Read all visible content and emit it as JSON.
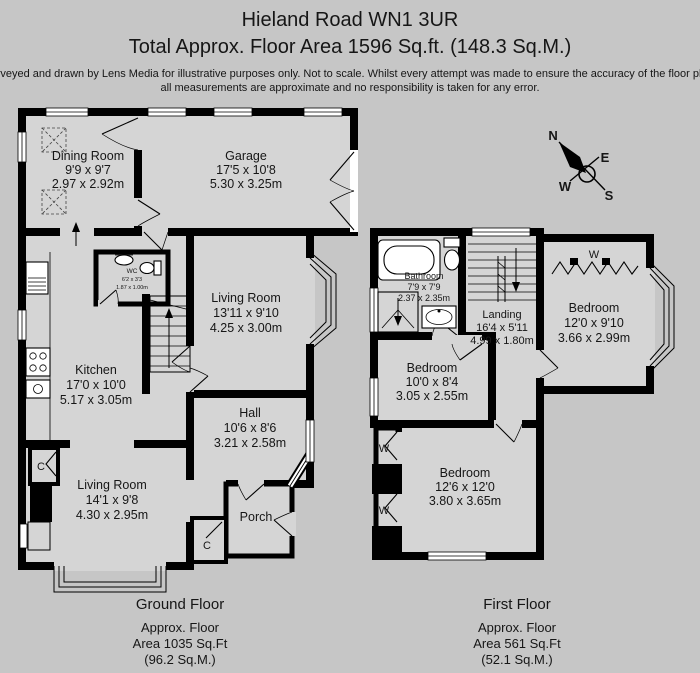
{
  "header": {
    "title": "Hieland Road WN1 3UR",
    "subtitle": "Total Approx. Floor Area 1596 Sq.ft. (148.3 Sq.M.)",
    "disclaimer1": "Surveyed and drawn by Lens Media for illustrative purposes only. Not to scale. Whilst every attempt was made to ensure the accuracy of the floor plan,",
    "disclaimer2": "all measurements are approximate and no responsibility is taken for any error."
  },
  "colors": {
    "background": "#c6c6c6",
    "room_fill": "#d5d5d5",
    "wall": "#000000"
  },
  "ground_floor": {
    "caption": {
      "title": "Ground Floor",
      "line1": "Approx. Floor",
      "line2": "Area 1035 Sq.Ft",
      "line3": "(96.2 Sq.M.)"
    },
    "rooms": {
      "dining": {
        "name": "Dining Room",
        "imperial": "9'9 x 9'7",
        "metric": "2.97 x 2.92m"
      },
      "garage": {
        "name": "Garage",
        "imperial": "17'5 x 10'8",
        "metric": "5.30 x 3.25m"
      },
      "wc": {
        "name": "WC",
        "imperial": "6'2 x 3'3",
        "metric": "1.87 x 1.00m"
      },
      "living1": {
        "name": "Living Room",
        "imperial": "13'11 x 9'10",
        "metric": "4.25 x 3.00m"
      },
      "kitchen": {
        "name": "Kitchen",
        "imperial": "17'0 x 10'0",
        "metric": "5.17 x 3.05m"
      },
      "hall": {
        "name": "Hall",
        "imperial": "10'6 x 8'6",
        "metric": "3.21 x 2.58m"
      },
      "living2": {
        "name": "Living Room",
        "imperial": "14'1 x 9'8",
        "metric": "4.30 x 2.95m"
      },
      "porch": {
        "name": "Porch"
      }
    },
    "cupboard_label": "C"
  },
  "first_floor": {
    "caption": {
      "title": "First Floor",
      "line1": "Approx. Floor",
      "line2": "Area 561 Sq.Ft",
      "line3": "(52.1 Sq.M.)"
    },
    "rooms": {
      "bathroom": {
        "name": "Bathroom",
        "imperial": "7'9 x 7'9",
        "metric": "2.37 x 2.35m"
      },
      "landing": {
        "name": "Landing",
        "imperial": "16'4 x 5'11",
        "metric": "4.99 x 1.80m"
      },
      "bedroom1": {
        "name": "Bedroom",
        "imperial": "12'0 x 9'10",
        "metric": "3.66 x 2.99m"
      },
      "bedroom2": {
        "name": "Bedroom",
        "imperial": "10'0 x 8'4",
        "metric": "3.05 x 2.55m"
      },
      "bedroom3": {
        "name": "Bedroom",
        "imperial": "12'6 x 12'0",
        "metric": "3.80 x 3.65m"
      }
    },
    "wardrobe_label": "W"
  },
  "compass": {
    "n": "N",
    "e": "E",
    "s": "S",
    "w": "W"
  }
}
